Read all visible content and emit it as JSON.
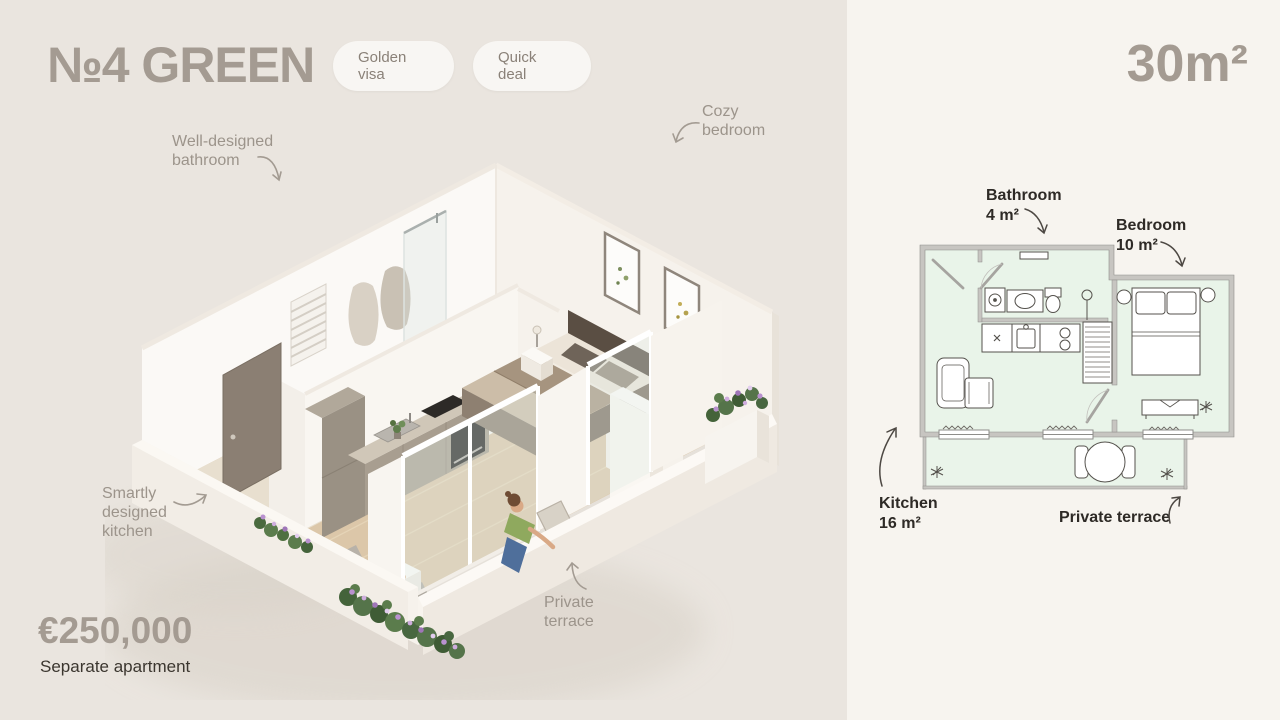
{
  "header": {
    "title": "№4 GREEN",
    "badges": [
      "Golden visa",
      "Quick deal"
    ],
    "area": "30m²"
  },
  "annotations": {
    "bathroom": [
      "Well-designed",
      "bathroom"
    ],
    "bedroom": [
      "Cozy",
      "bedroom"
    ],
    "kitchen": [
      "Smartly",
      "designed",
      "kitchen"
    ],
    "terrace": [
      "Private",
      "terrace"
    ]
  },
  "floorplan": {
    "bathroom": {
      "name": "Bathroom",
      "area": "4 m²"
    },
    "bedroom": {
      "name": "Bedroom",
      "area": "10 m²"
    },
    "kitchen": {
      "name": "Kitchen",
      "area": "16 m²"
    },
    "terrace": {
      "name": "Private terrace"
    }
  },
  "price": {
    "amount": "€250,000",
    "label": "Separate apartment"
  },
  "colors": {
    "left_background": "#eae5df",
    "right_background": "#f7f4ef",
    "muted_heading": "#a49b92",
    "annotation_text": "#9c948b",
    "plan_room_fill": "#e9f4e9",
    "plan_wall": "#c7c5c1",
    "wood_floor": "#dcc7a9",
    "flower_purple": "#b991cf"
  }
}
